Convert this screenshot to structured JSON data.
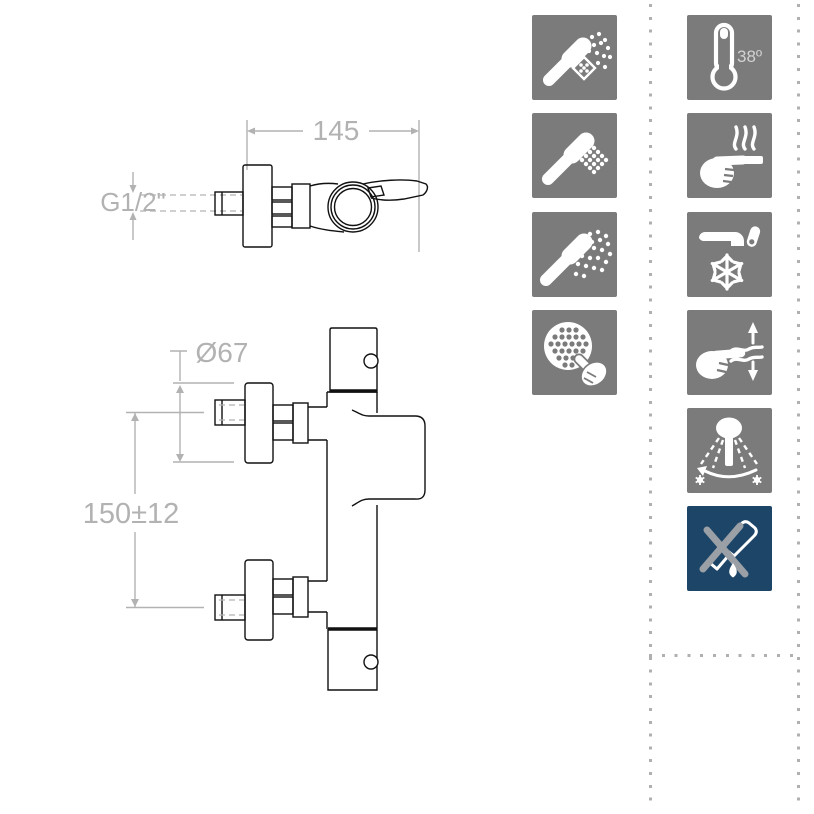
{
  "sheet": {
    "name": "thermostatic-shower-mixer-spec"
  },
  "drawing": {
    "dim_width": "145",
    "dim_thread": "G1/2\"",
    "dim_diameter": "Ø67",
    "dim_distance": "150±12",
    "line_color": "#111111",
    "dim_color": "#b2b2b2"
  },
  "icons": {
    "left_column": [
      {
        "name": "handshower-massage-spray-icon"
      },
      {
        "name": "handshower-rain-spray-icon"
      },
      {
        "name": "handshower-wide-spray-icon"
      },
      {
        "name": "easy-clean-nozzles-icon"
      }
    ],
    "right_column": [
      {
        "name": "thermostat-38-degrees-icon",
        "label": "38º"
      },
      {
        "name": "cool-touch-body-icon"
      },
      {
        "name": "cold-start-icon"
      },
      {
        "name": "flow-control-icon"
      },
      {
        "name": "adjustable-spray-angle-icon"
      },
      {
        "name": "anti-drip-icon"
      }
    ],
    "colors": {
      "tile_gray": "#7b7b7b",
      "tile_blue": "#1d4568",
      "glyph": "#ffffff",
      "cross_gray": "#9aa0a6",
      "label_gray": "#d2d2d2"
    }
  },
  "separators": {
    "dot_color": "#b0b0b0"
  }
}
